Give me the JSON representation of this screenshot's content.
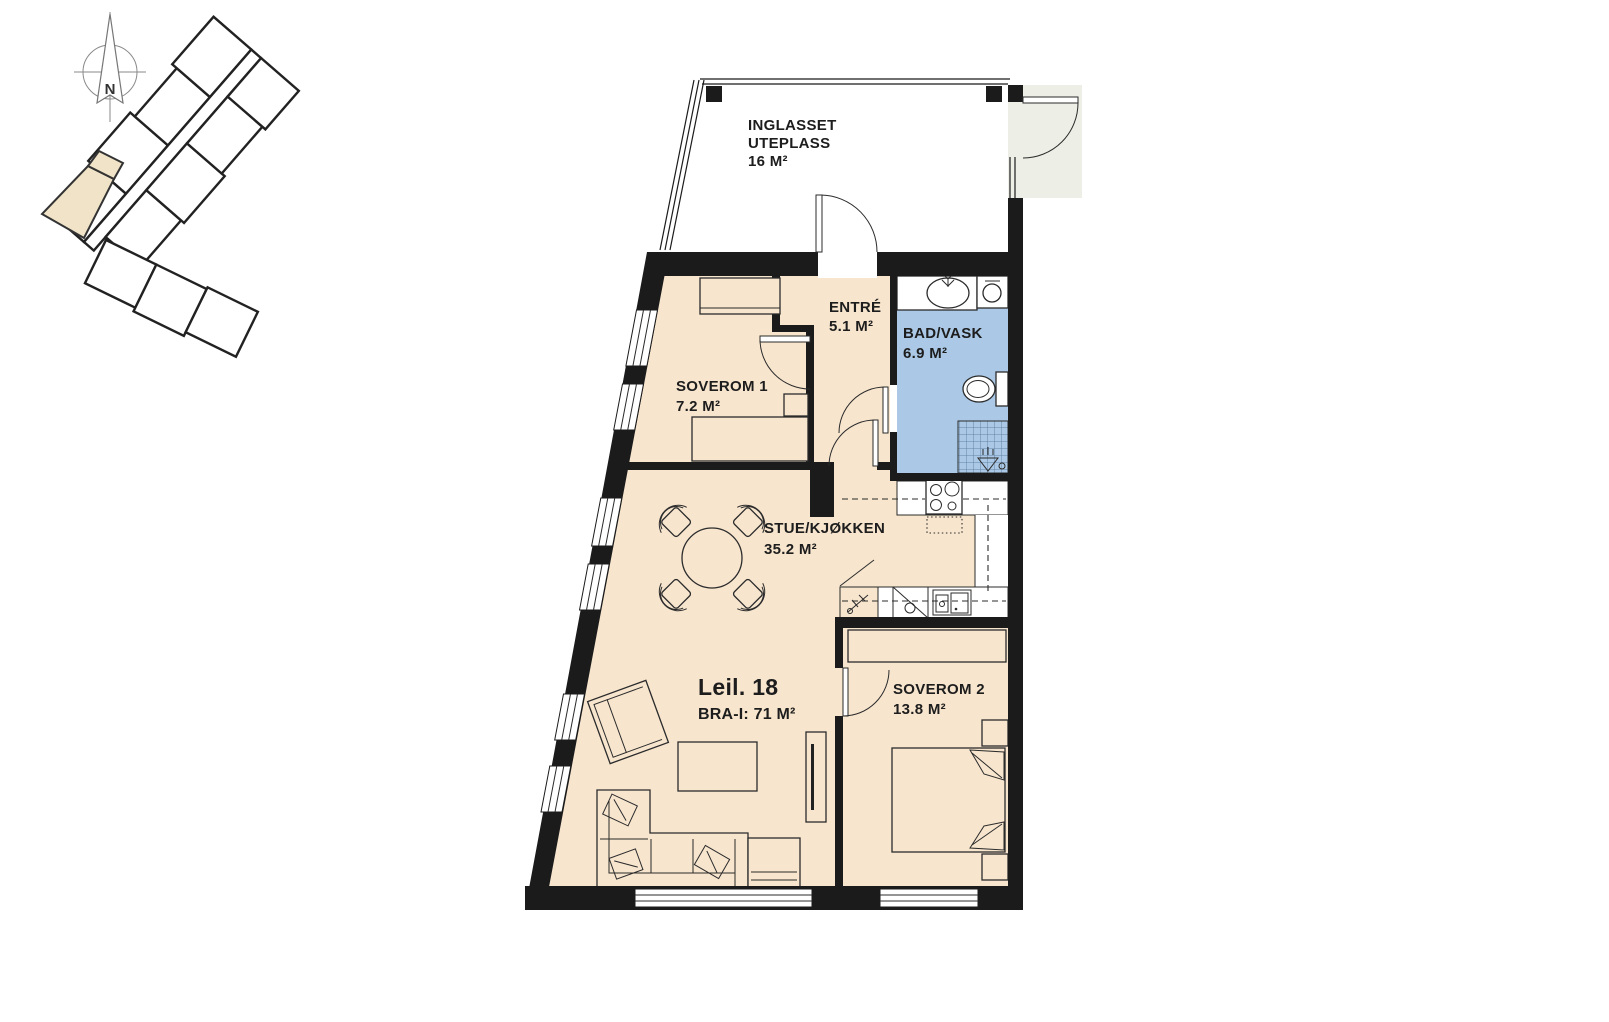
{
  "colors": {
    "floor": "#f7e5ce",
    "bathroom": "#abc9e6",
    "exterior_landing": "#edefe6",
    "wall": "#1b1b1b",
    "site_highlight": "#f0e3c7"
  },
  "compass": {
    "north_label": "N"
  },
  "apartment": {
    "name": "Leil. 18",
    "area": "BRA-I: 71 M²"
  },
  "rooms": {
    "uteplass": {
      "line1": "INGLASSET",
      "line2": "UTEPLASS",
      "area": "16 M²"
    },
    "entre": {
      "name": "ENTRÉ",
      "area": "5.1 M²"
    },
    "bad": {
      "name": "BAD/VASK",
      "area": "6.9 M²"
    },
    "soverom1": {
      "name": "SOVEROM 1",
      "area": "7.2 M²"
    },
    "stue": {
      "name": "STUE/KJØKKEN",
      "area": "35.2 M²"
    },
    "soverom2": {
      "name": "SOVEROM 2",
      "area": "13.8 M²"
    }
  }
}
